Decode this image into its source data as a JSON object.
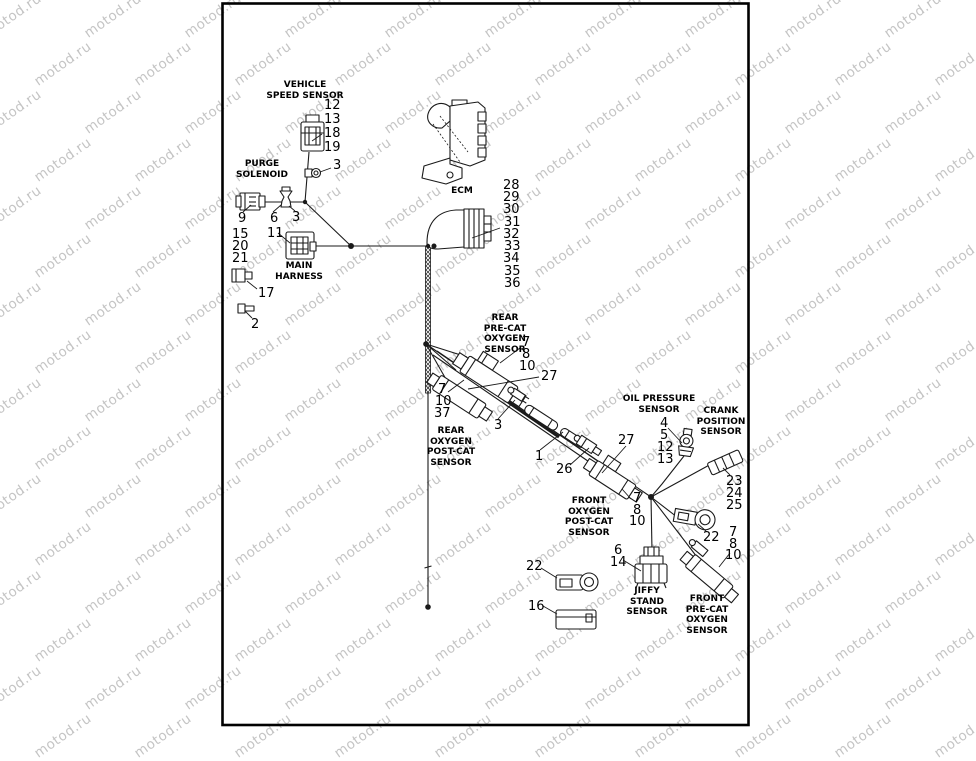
{
  "watermark": {
    "text": "motod.ru",
    "color": "#c4c4c4"
  },
  "diagram": {
    "border_color": "#000000",
    "line_color": "#1a1a1a",
    "labels": [
      {
        "id": "vehicle-speed-sensor-label",
        "lines": [
          "VEHICLE",
          "SPEED SENSOR"
        ],
        "x": 305,
        "y": 80
      },
      {
        "id": "purge-solenoid-label",
        "lines": [
          "PURGE",
          "SOLENOID"
        ],
        "x": 262,
        "y": 159
      },
      {
        "id": "main-harness-label",
        "lines": [
          "MAIN",
          "HARNESS"
        ],
        "x": 299,
        "y": 261
      },
      {
        "id": "ecm-label",
        "lines": [
          "ECM"
        ],
        "x": 462,
        "y": 186
      },
      {
        "id": "rear-pre-cat-oxygen-sensor-label",
        "lines": [
          "REAR",
          "PRE-CAT",
          "OXYGEN",
          "SENSOR"
        ],
        "x": 505,
        "y": 313
      },
      {
        "id": "rear-oxygen-post-cat-sensor-label",
        "lines": [
          "REAR",
          "OXYGEN",
          "POST-CAT",
          "SENSOR"
        ],
        "x": 451,
        "y": 426
      },
      {
        "id": "oil-pressure-sensor-label",
        "lines": [
          "OIL PRESSURE",
          "SENSOR"
        ],
        "x": 659,
        "y": 394
      },
      {
        "id": "crank-position-sensor-label",
        "lines": [
          "CRANK",
          "POSITION",
          "SENSOR"
        ],
        "x": 721,
        "y": 406
      },
      {
        "id": "front-oxygen-post-cat-sensor-label",
        "lines": [
          "FRONT",
          "OXYGEN",
          "POST-CAT",
          "SENSOR"
        ],
        "x": 589,
        "y": 496
      },
      {
        "id": "jiffy-stand-sensor-label",
        "lines": [
          "JIFFY",
          "STAND",
          "SENSOR"
        ],
        "x": 647,
        "y": 586
      },
      {
        "id": "front-pre-cat-oxygen-sensor-label",
        "lines": [
          "FRONT",
          "PRE-CAT",
          "OXYGEN",
          "SENSOR"
        ],
        "x": 707,
        "y": 594
      }
    ],
    "callouts": [
      {
        "id": "callout-12-vss",
        "text": "12",
        "x": 324,
        "y": 99
      },
      {
        "id": "callout-13-vss",
        "text": "13",
        "x": 324,
        "y": 113
      },
      {
        "id": "callout-18-vss",
        "text": "18",
        "x": 324,
        "y": 127
      },
      {
        "id": "callout-19-vss",
        "text": "19",
        "x": 324,
        "y": 141
      },
      {
        "id": "callout-3-vss",
        "text": "3",
        "x": 333,
        "y": 159
      },
      {
        "id": "callout-9-purge",
        "text": "9",
        "x": 238,
        "y": 212
      },
      {
        "id": "callout-6-purge",
        "text": "6",
        "x": 270,
        "y": 212
      },
      {
        "id": "callout-3-purge",
        "text": "3",
        "x": 292,
        "y": 211
      },
      {
        "id": "callout-15",
        "text": "15",
        "x": 232,
        "y": 228
      },
      {
        "id": "callout-20",
        "text": "20",
        "x": 232,
        "y": 240
      },
      {
        "id": "callout-21",
        "text": "21",
        "x": 232,
        "y": 252
      },
      {
        "id": "callout-11",
        "text": "11",
        "x": 267,
        "y": 227
      },
      {
        "id": "callout-17",
        "text": "17",
        "x": 258,
        "y": 287
      },
      {
        "id": "callout-2",
        "text": "2",
        "x": 251,
        "y": 318
      },
      {
        "id": "callout-28-ecm",
        "text": "28",
        "x": 503,
        "y": 179
      },
      {
        "id": "callout-29-ecm",
        "text": "29",
        "x": 503,
        "y": 191
      },
      {
        "id": "callout-30-ecm",
        "text": "30",
        "x": 503,
        "y": 203
      },
      {
        "id": "callout-31-ecm",
        "text": "31",
        "x": 504,
        "y": 216
      },
      {
        "id": "callout-32-ecm",
        "text": "32",
        "x": 503,
        "y": 228
      },
      {
        "id": "callout-33-ecm",
        "text": "33",
        "x": 504,
        "y": 240
      },
      {
        "id": "callout-34-ecm",
        "text": "34",
        "x": 503,
        "y": 252
      },
      {
        "id": "callout-35-ecm",
        "text": "35",
        "x": 504,
        "y": 265
      },
      {
        "id": "callout-36-ecm",
        "text": "36",
        "x": 504,
        "y": 277
      },
      {
        "id": "callout-7-rear-precat",
        "text": "7",
        "x": 522,
        "y": 336
      },
      {
        "id": "callout-8-rear-precat",
        "text": "8",
        "x": 522,
        "y": 348
      },
      {
        "id": "callout-10-rear-precat",
        "text": "10",
        "x": 519,
        "y": 360
      },
      {
        "id": "callout-27-rear",
        "text": "27",
        "x": 541,
        "y": 370
      },
      {
        "id": "callout-7-rear-postcat",
        "text": "7",
        "x": 438,
        "y": 383
      },
      {
        "id": "callout-10-rear-postcat",
        "text": "10",
        "x": 435,
        "y": 395
      },
      {
        "id": "callout-37",
        "text": "37",
        "x": 434,
        "y": 407
      },
      {
        "id": "callout-3-mid",
        "text": "3",
        "x": 494,
        "y": 419
      },
      {
        "id": "callout-1",
        "text": "1",
        "x": 535,
        "y": 450
      },
      {
        "id": "callout-26",
        "text": "26",
        "x": 556,
        "y": 463
      },
      {
        "id": "callout-27-front",
        "text": "27",
        "x": 618,
        "y": 434
      },
      {
        "id": "callout-4-oil",
        "text": "4",
        "x": 660,
        "y": 417
      },
      {
        "id": "callout-5-oil",
        "text": "5",
        "x": 660,
        "y": 429
      },
      {
        "id": "callout-12-oil",
        "text": "12",
        "x": 657,
        "y": 441
      },
      {
        "id": "callout-13-oil",
        "text": "13",
        "x": 657,
        "y": 453
      },
      {
        "id": "callout-23-crank",
        "text": "23",
        "x": 726,
        "y": 475
      },
      {
        "id": "callout-24-crank",
        "text": "24",
        "x": 726,
        "y": 487
      },
      {
        "id": "callout-25-crank",
        "text": "25",
        "x": 726,
        "y": 499
      },
      {
        "id": "callout-7-front-postcat",
        "text": "7",
        "x": 633,
        "y": 492
      },
      {
        "id": "callout-8-front-postcat",
        "text": "8",
        "x": 633,
        "y": 504
      },
      {
        "id": "callout-10-front-postcat",
        "text": "10",
        "x": 629,
        "y": 515
      },
      {
        "id": "callout-22-neutral",
        "text": "22",
        "x": 703,
        "y": 531
      },
      {
        "id": "callout-7-front-precat",
        "text": "7",
        "x": 729,
        "y": 526
      },
      {
        "id": "callout-8-front-precat",
        "text": "8",
        "x": 729,
        "y": 538
      },
      {
        "id": "callout-10-front-precat",
        "text": "10",
        "x": 725,
        "y": 549
      },
      {
        "id": "callout-6-jiffy",
        "text": "6",
        "x": 614,
        "y": 544
      },
      {
        "id": "callout-14-jiffy",
        "text": "14",
        "x": 610,
        "y": 556
      },
      {
        "id": "callout-22-eyelet",
        "text": "22",
        "x": 526,
        "y": 560
      },
      {
        "id": "callout-16",
        "text": "16",
        "x": 528,
        "y": 600
      }
    ]
  }
}
